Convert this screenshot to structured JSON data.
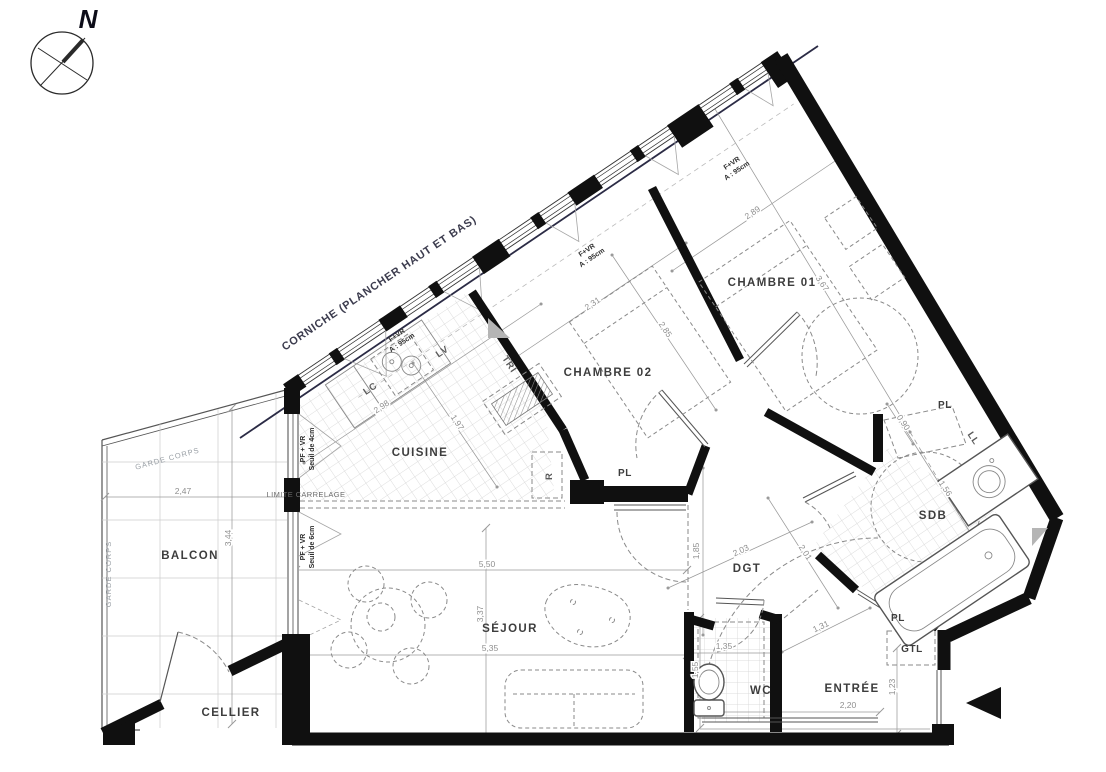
{
  "compass": {
    "label": "N"
  },
  "rooms": [
    {
      "label": "CHAMBRE 01"
    },
    {
      "label": "CHAMBRE 02"
    },
    {
      "label": "CUISINE"
    },
    {
      "label": "SÉJOUR"
    },
    {
      "label": "BALCON"
    },
    {
      "label": "CELLIER"
    },
    {
      "label": "WC"
    },
    {
      "label": "ENTRÉE"
    },
    {
      "label": "SDB"
    },
    {
      "label": "DGT"
    }
  ],
  "closets": [
    {
      "label": "PL"
    },
    {
      "label": "PL"
    },
    {
      "label": "PL"
    },
    {
      "label": "GTL"
    }
  ],
  "appliances": [
    {
      "label": "LC"
    },
    {
      "label": "LV"
    },
    {
      "label": "TRI"
    },
    {
      "label": "R"
    },
    {
      "label": "LL"
    }
  ],
  "windows": [
    {
      "t": "F+VR",
      "s": "A : 95cm"
    },
    {
      "t": "F+VR",
      "s": "A : 95cm"
    },
    {
      "t": "F+VR",
      "s": "A : 95cm"
    }
  ],
  "thresholds": [
    {
      "t": "PF + VR",
      "s": "Seuil de 4cm"
    },
    {
      "t": "PF + VR",
      "s": "Seuil de 6cm"
    }
  ],
  "annotations": {
    "corniche": "CORNICHE (PLANCHER HAUT ET BAS)",
    "garde_corps": "GARDE CORPS",
    "limite": "LIMITE CARRELAGE"
  },
  "dimensions": [
    {
      "value": "2,47"
    },
    {
      "value": "3,44"
    },
    {
      "value": "2,98"
    },
    {
      "value": "1,97"
    },
    {
      "value": "2,31"
    },
    {
      "value": "2,85"
    },
    {
      "value": "2,89"
    },
    {
      "value": "3,67"
    },
    {
      "value": "5,50"
    },
    {
      "value": "5,35"
    },
    {
      "value": "3,37"
    },
    {
      "value": "1,35"
    },
    {
      "value": "1,55"
    },
    {
      "value": "2,20"
    },
    {
      "value": "1,23"
    },
    {
      "value": "1,31"
    },
    {
      "value": "2,03"
    },
    {
      "value": "2,01"
    },
    {
      "value": "1,85"
    },
    {
      "value": "0,90"
    },
    {
      "value": "1,56"
    }
  ]
}
